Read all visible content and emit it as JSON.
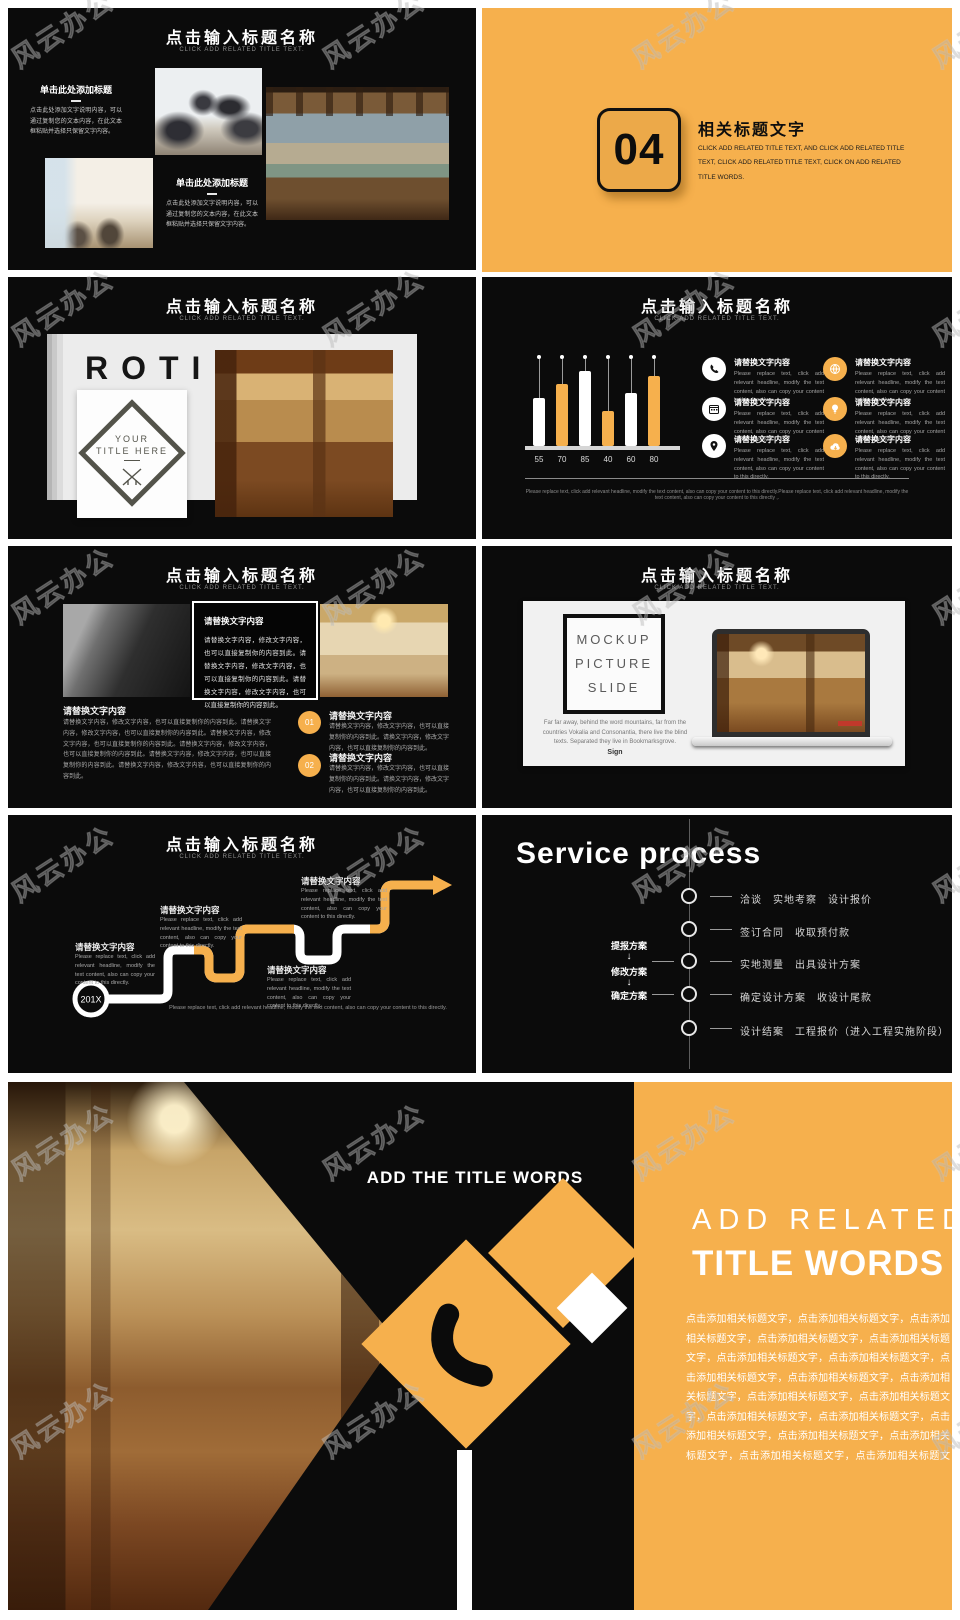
{
  "page": {
    "watermark": "风云办公",
    "background": "#ffffff"
  },
  "colors": {
    "accent": "#F6B04D",
    "slide_bg": "#0b0b0b",
    "white": "#ffffff"
  },
  "common": {
    "title": "点击输入标题名称",
    "subtitle": "CLICK ADD RELATED TITLE TEXT."
  },
  "chart_data": {
    "type": "bar",
    "categories": [
      "55",
      "70",
      "85",
      "40",
      "60",
      "80"
    ],
    "values": [
      55,
      70,
      85,
      40,
      60,
      80
    ],
    "title": "点击输入标题名称",
    "xlabel": "",
    "ylabel": "",
    "ylim": [
      0,
      100
    ],
    "legend_position": "none",
    "grid": false,
    "bar_colors": [
      "#ffffff",
      "#F6B04D",
      "#ffffff",
      "#F6B04D",
      "#ffffff",
      "#F6B04D"
    ]
  },
  "slides": {
    "s1": {
      "title": "点击输入标题名称",
      "subtitle": "CLICK ADD RELATED TITLE TEXT.",
      "block1": {
        "heading": "单击此处添加标题",
        "body": "点击此处添加文字说明内容，可以通过复制您的文本内容，在此文本框粘贴并选择只保留文字内容。"
      },
      "block2": {
        "heading": "单击此处添加标题",
        "body": "点击此处添加文字说明内容，可以通过复制您的文本内容，在此文本框粘贴并选择只保留文字内容。"
      }
    },
    "s2": {
      "number": "04",
      "heading": "相关标题文字",
      "body": "CLICK ADD RELATED TITLE TEXT, AND CLICK ADD RELATED TITLE TEXT, CLICK ADD RELATED TITLE TEXT, CLICK ON ADD RELATED TITLE WORDS."
    },
    "s3": {
      "title": "点击输入标题名称",
      "subtitle": "CLICK ADD RELATED TITLE TEXT.",
      "big_text": "ROTI",
      "diamond_line1": "YOUR",
      "diamond_line2": "TITLE HERE"
    },
    "s4": {
      "title": "点击输入标题名称",
      "subtitle": "CLICK ADD RELATED TITLE TEXT.",
      "chart": {
        "values": [
          55,
          70,
          85,
          40,
          60,
          80
        ],
        "labels": [
          "55",
          "70",
          "85",
          "40",
          "60",
          "80"
        ]
      },
      "items": [
        {
          "icon": "phone-icon",
          "title": "请替换文字内容",
          "body": "Please replace text, click add relevant headline, modify the text content, also can copy your content to this directly."
        },
        {
          "icon": "globe-icon",
          "title": "请替换文字内容",
          "body": "Please replace text, click add relevant headline, modify the text content, also can copy your content to this directly."
        },
        {
          "icon": "calendar-icon",
          "title": "请替换文字内容",
          "body": "Please replace text, click add relevant headline, modify the text content, also can copy your content to this directly."
        },
        {
          "icon": "bulb-icon",
          "title": "请替换文字内容",
          "body": "Please replace text, click add relevant headline, modify the text content, also can copy your content to this directly."
        },
        {
          "icon": "pin-icon",
          "title": "请替换文字内容",
          "body": "Please replace text, click add relevant headline, modify the text content, also can copy your content to this directly."
        },
        {
          "icon": "cloud-icon",
          "title": "请替换文字内容",
          "body": "Please replace text, click add relevant headline, modify the text content, also can copy your content to this directly."
        }
      ],
      "footer": "Please replace text, click add relevant headline, modify the text content, also can copy your content to this directly.Please replace text, click add relevant headline, modify the text content, also can copy your content to this directly ,."
    },
    "s5": {
      "title": "点击输入标题名称",
      "subtitle": "CLICK ADD RELATED TITLE TEXT.",
      "box": {
        "heading": "请替换文字内容",
        "body": "请替换文字内容，修改文字内容，也可以直接复制你的内容到此。请替换文字内容，修改文字内容，也可以直接复制你的内容到此。请替换文字内容，修改文字内容，也可以直接复制你的内容到此。"
      },
      "left": {
        "heading": "请替换文字内容",
        "body": "请替换文字内容，修改文字内容，也可以直接复制你的内容到此。请替换文字内容，修改文字内容，也可以直接复制你的内容到此。请替换文字内容，修改文字内容，也可以直接复制你的内容到此。请替换文字内容，修改文字内容，也可以直接复制你的内容到此。请替换文字内容，修改文字内容，也可以直接复制你的内容到此。请替换文字内容，修改文字内容，也可以直接复制你的内容到此。"
      },
      "items": [
        {
          "num": "01",
          "title": "请替换文字内容",
          "body": "请替换文字内容，修改文字内容，也可以直接复制你的内容到此。请换文字内容，修改文字内容，也可以直接复制你的内容到此。"
        },
        {
          "num": "02",
          "title": "请替换文字内容",
          "body": "请替换文字内容，修改文字内容，也可以直接复制你的内容到此。请换文字内容，修改文字内容，也可以直接复制你的内容到此。"
        }
      ]
    },
    "s6": {
      "title": "点击输入标题名称",
      "subtitle": "CLICK ADD RELATED TITLE TEXT.",
      "mock_line1": "MOCKUP",
      "mock_line2": "PICTURE",
      "mock_line3": "SLIDE",
      "para": "Far far away, behind the word mountains, far from the countries Vokalia and Consonantia, there live the blind texts. Separated they live in Bookmarksgrove.",
      "sign": "Sign"
    },
    "s7": {
      "title": "点击输入标题名称",
      "subtitle": "CLICK ADD RELATED TITLE TEXT.",
      "year": "201X",
      "blocks": [
        {
          "title": "请替换文字内容",
          "body": "Please replace text, click add relevant headline, modify the text content, also can copy your content to this directly."
        },
        {
          "title": "请替换文字内容",
          "body": "Please replace text, click add relevant headline, modify the text content, also can copy your content to this directly."
        },
        {
          "title": "请替换文字内容",
          "body": "Please replace text, click add relevant headline, modify the text content, also can copy your content to this directly."
        },
        {
          "title": "请替换文字内容",
          "body": "Please replace text, click add relevant headline, modify the text content, also can copy your content to this directly."
        }
      ],
      "caption": "Please replace text, click add relevant headline, modify the text content, also can copy your content to this directly."
    },
    "s8": {
      "title": "Service process",
      "steps": [
        "洽谈　实地考察　设计报价",
        "签订合同　收取预付款",
        "实地测量　出具设计方案",
        "确定设计方案　收设计尾款",
        "设计结案　工程报价（进入工程实施阶段）"
      ],
      "side_labels": [
        "提报方案",
        "修改方案",
        "确定方案"
      ],
      "arrow": "↓"
    },
    "s9": {
      "photo_title": "ADD THE TITLE WORDS",
      "title_line1": "ADD RELATED",
      "title_line2": "TITLE WORDS",
      "body": "点击添加相关标题文字，点击添加相关标题文字，点击添加相关标题文字，点击添加相关标题文字，点击添加相关标题文字，点击添加相关标题文字，点击添加相关标题文字，点击添加相关标题文字，点击添加相关标题文字，点击添加相关标题文字，点击添加相关标题文字，点击添加相关标题文字，点击添加相关标题文字，点击添加相关标题文字，点击添加相关标题文字，点击添加相关标题文字，点击添加相关标题文字，点击添加相关标题文字，点击添加相关标题文字，点击添加相关标题文字。"
    }
  }
}
